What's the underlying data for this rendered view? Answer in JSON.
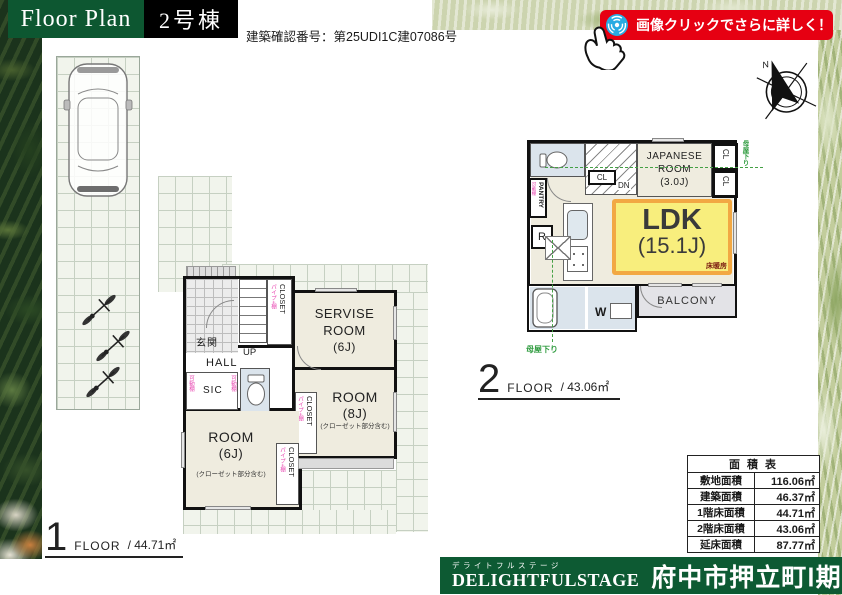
{
  "header": {
    "title": "Floor Plan",
    "building_no": "2号棟",
    "confirmation_number": "建築確認番号：第25UDI1C建07086号",
    "badge_label": "画像クリックでさらに詳しく！"
  },
  "compass": {
    "north_label": "N"
  },
  "floor1": {
    "number": "1",
    "floor_word": "FLOOR",
    "area_text": "/ 44.71㎡",
    "rooms": {
      "genkan": "玄関",
      "up": "UP",
      "hall": "HALL",
      "sic": "SIC",
      "service_room": "SERVISE ROOM",
      "service_size": "(6J)",
      "room8": "ROOM",
      "room8_size": "(8J)",
      "room8_note": "(クローゼット部分含む)",
      "room6": "ROOM",
      "room6_size": "(6J)",
      "room6_note": "(クローゼット部分含む)"
    }
  },
  "floor2": {
    "number": "2",
    "floor_word": "FLOOR",
    "area_text": "/ 43.06㎡",
    "rooms": {
      "japanese_line1": "JAPANESE",
      "japanese_line2": "ROOM",
      "japanese_size": "(3.0J)",
      "ldk": "LDK",
      "ldk_size": "(15.1J)",
      "floor_heating": "床暖房",
      "balcony": "BALCONY",
      "pantry": "PANTRY",
      "cl": "CL",
      "dn": "DN",
      "fridge": "R",
      "washer": "W",
      "moya_sagari": "母屋下り"
    }
  },
  "shared_labels": {
    "closet": "CLOSET",
    "pipe_shelf": "パイプ+棚",
    "movable_shelf": "可動棚"
  },
  "area_table": {
    "title": "面 積 表",
    "rows": [
      {
        "label": "敷地面積",
        "value": "116.06㎡"
      },
      {
        "label": "建築面積",
        "value": "46.37㎡"
      },
      {
        "label": "1階床面積",
        "value": "44.71㎡"
      },
      {
        "label": "2階床面積",
        "value": "43.06㎡"
      },
      {
        "label": "延床面積",
        "value": "87.77㎡"
      }
    ]
  },
  "footer": {
    "ruby": "デライトフルステージ",
    "brand": "DELIGHTFULSTAGE",
    "project": "府中市押立町Ⅰ期"
  },
  "colors": {
    "brand_green": "#0d5731",
    "badge_red": "#e60012",
    "accent_blue": "#29abe2",
    "ldk_yellow": "#f8ee7d",
    "ldk_border_orange": "#f2a843",
    "annotation_green": "#2f9b3f",
    "annotation_pink": "#e73fae"
  }
}
